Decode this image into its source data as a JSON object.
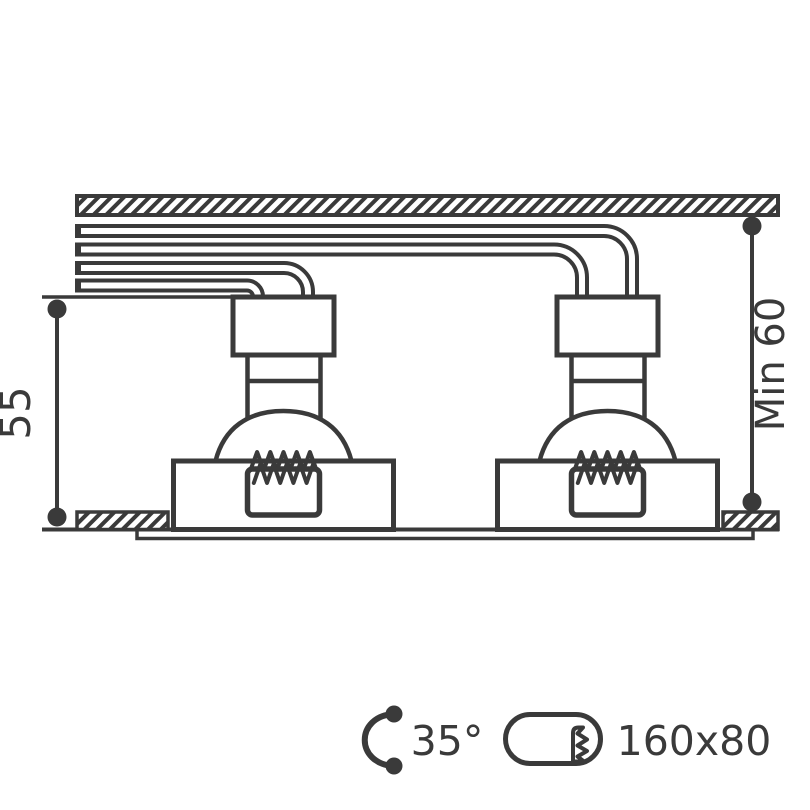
{
  "drawing": {
    "title": "recessed downlight installation cross-section",
    "line_color": "#3a3a3a",
    "background_color": "#ffffff"
  },
  "dimensions": {
    "fixture_height": "55",
    "min_recess_depth": "Min 60"
  },
  "specs": {
    "tilt_angle": "35°",
    "cutout_size": "160x80"
  },
  "icons": {
    "tilt": "tilt-angle-icon",
    "cutout": "cutout-shape-icon"
  }
}
